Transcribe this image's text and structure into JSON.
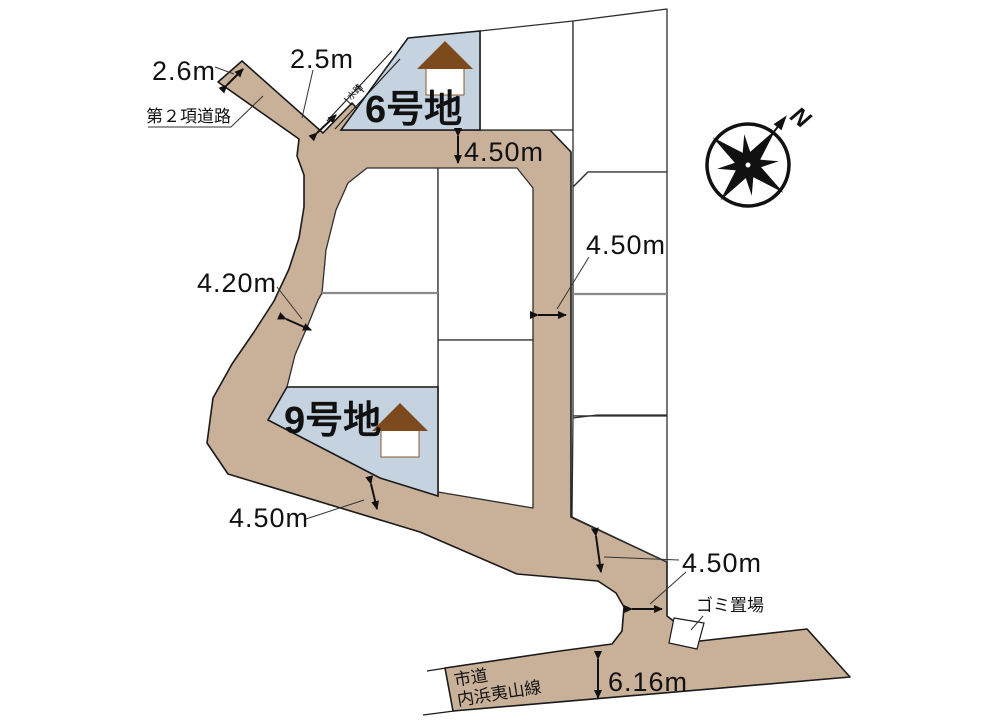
{
  "map_type": "residential-subdivision-plot-plan",
  "colors": {
    "road_fill": "#c9b199",
    "highlight_lot_fill": "#c4d3df",
    "lot_fill": "#ffffff",
    "outline": "#1a1a1a",
    "gray_boundary": "#8a8a8a",
    "roof": "#7d4a1e"
  },
  "lots": {
    "lot6": {
      "label": "6号地",
      "highlighted": true
    },
    "lot9": {
      "label": "9号地",
      "highlighted": true
    }
  },
  "dims": {
    "west_road_tip_width": "2.6m",
    "west_road_neck_width": "2.5m",
    "north_road_width": "4.50m",
    "east_road_width": "4.50m",
    "curve_road_width": "4.20m",
    "south_road_width": "4.50m",
    "merge_road_width": "4.50m",
    "city_road_width": "6.16m"
  },
  "labels": {
    "setback_road": "第２項道路",
    "waterway": "水路",
    "garbage_station": "ゴミ置場",
    "city_road_name_line1": "市道",
    "city_road_name_line2": "内浜夷山線",
    "compass_north": "N"
  }
}
